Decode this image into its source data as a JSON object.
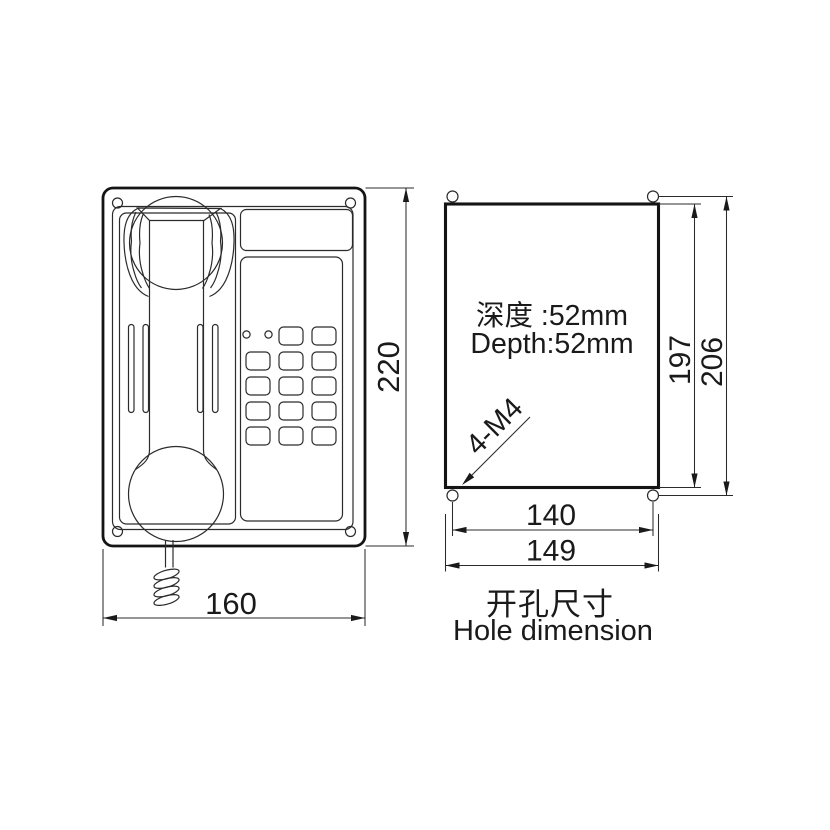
{
  "drawing": {
    "front_view": {
      "height_dim": "220",
      "width_dim": "160"
    },
    "hole_view": {
      "depth_label_cn": "深度 :52mm",
      "depth_label_en": "Depth:52mm",
      "screw_spec": "4-M4",
      "inner_height_dim": "197",
      "outer_height_dim": "206",
      "inner_width_dim": "140",
      "outer_width_dim": "149",
      "caption_cn": "开孔尺寸",
      "caption_en": "Hole dimension"
    }
  },
  "keypad_layout": {
    "rows": 5,
    "cols": 3,
    "x0": 246,
    "y0": 327,
    "col_pitch": 33,
    "row_pitch": 25,
    "button_w": 24,
    "button_h": 18,
    "corner_r": 4.5,
    "led_row": 0,
    "led_col": 0,
    "leds": {
      "cx": [
        246.5,
        268.5
      ],
      "cy": 334.5,
      "r": 3.6
    }
  },
  "colors": {
    "line": "#2b2b2b",
    "line_heavy": "#141414",
    "text": "#1a1a1a",
    "background": "#ffffff"
  }
}
